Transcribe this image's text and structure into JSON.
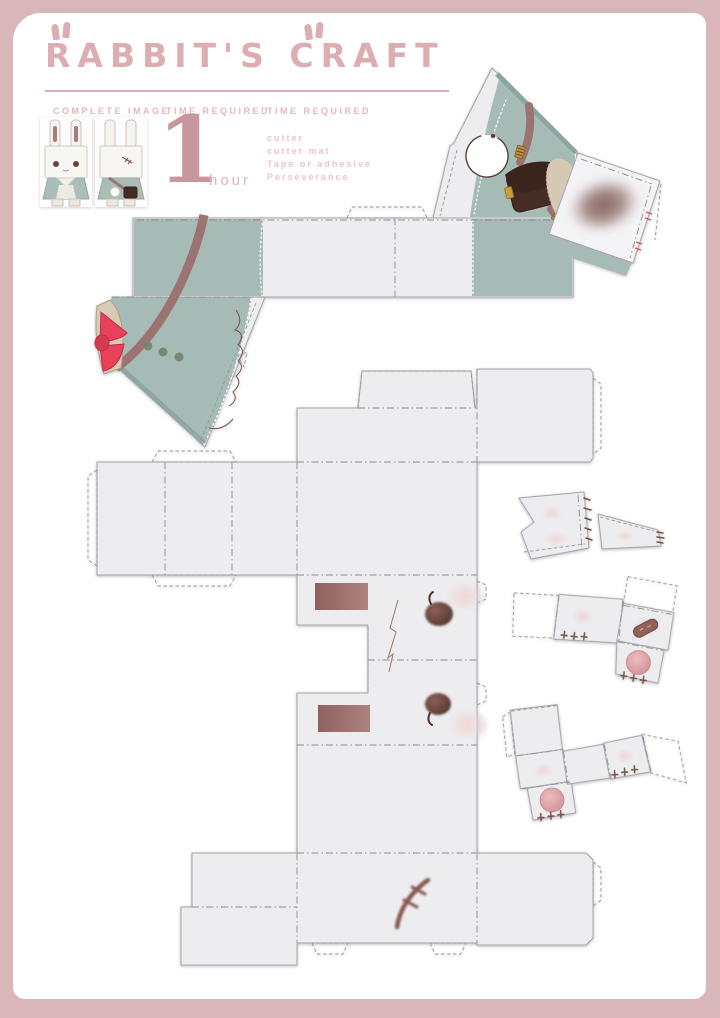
{
  "header": {
    "title": "RABBIT'S CRAFT"
  },
  "info": {
    "complete_image_label": "COMPLETE IMAGE",
    "time_label": "TIME REQUIRED",
    "time_value": "1",
    "time_unit": "hour",
    "tools_label": "TIME REQUIRED",
    "tools": [
      "cutter",
      "cutter mat",
      "Tape or adhesive",
      "Perseverance"
    ]
  },
  "colors": {
    "frame": "#d9b6b9",
    "accent_pink": "#dcadb1",
    "label_pink": "#e3b8bc",
    "list_pink": "#ecc5c8",
    "number_pink": "#c9969b",
    "paper": "#ededef",
    "teal": "#a6bab6",
    "teal_dark": "#8ba6a1",
    "mauve": "#9b6f6c",
    "eye_brown": "#5d3f3a",
    "strap_brown": "#9b7471",
    "satchel_brown": "#452c25",
    "bow_red": "#e8415a",
    "beige": "#d6c9b4",
    "paw_pink": "#dfa0a4",
    "blush": "#f0d5d4",
    "scar_brown": "#8a5a52",
    "button_olive": "#75826c"
  },
  "pieces": [
    "dress-wrap-template",
    "body-and-head-template",
    "ear-template-large",
    "ear-template-small",
    "arm-template-right",
    "arm-template-left"
  ]
}
